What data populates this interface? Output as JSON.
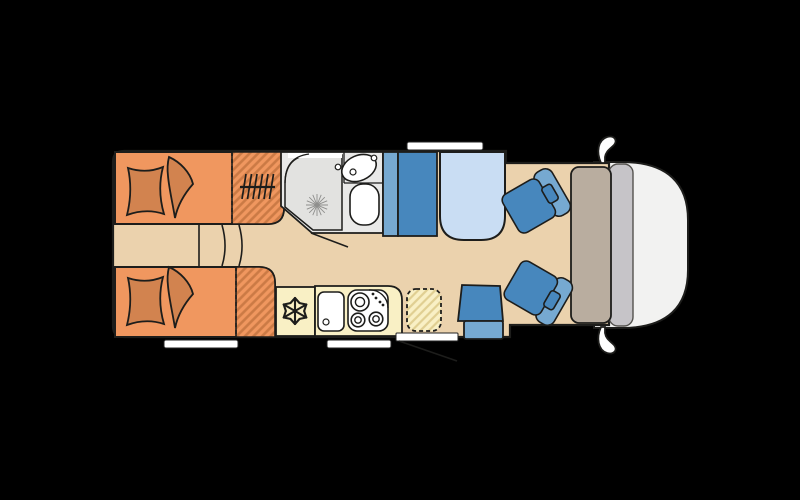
{
  "page": {
    "background": "#000000",
    "description": "Motorhome floor plan, top view, cab facing right"
  },
  "colors": {
    "background": "#000000",
    "outline": "#1d1d1b",
    "floor": "#ebd2ad",
    "bed_orange": "#f0975f",
    "stripe_orange": "#cb7a45",
    "cushion_orange": "#d2834f",
    "kitchen_yellow": "#f9f0c5",
    "stripe_yellow": "#e0cf92",
    "seat_blue": "#4787bd",
    "seat_blue_light": "#76a9d1",
    "table_blue": "#c9ddf3",
    "bath_floor": "#e9e9e8",
    "shower_tray": "#e2e2e0",
    "fixture_white": "#ffffff",
    "dash_gray": "#b9ad9f",
    "windshield_gray": "#c6c4c8",
    "cab_white": "#f2f2f1",
    "window_white": "#ffffff"
  },
  "components": {
    "rear_beds": {
      "count": 2,
      "type": "twin single beds",
      "icons": [
        "pillow-icon",
        "blanket-icon"
      ]
    },
    "wardrobes": {
      "count": 2,
      "icon": "hanger-rail-icon"
    },
    "bathroom": {
      "fixtures": [
        "shower",
        "washbasin",
        "toilet"
      ],
      "icon": "sunburst-icon"
    },
    "kitchen": {
      "fixtures": [
        "freezer",
        "sink",
        "hob"
      ],
      "hob_burners": 3,
      "icon": "snowflake-icon"
    },
    "lounge": {
      "bench_seats": 1,
      "side_seats": 1,
      "tables": 1
    },
    "cab": {
      "swivel_seats": 2,
      "mirrors": 2,
      "windshield": 1,
      "dashboard": 1
    },
    "windows": {
      "count": 3
    },
    "door_swings": {
      "count": 2
    },
    "steps": {
      "count": 3
    }
  }
}
